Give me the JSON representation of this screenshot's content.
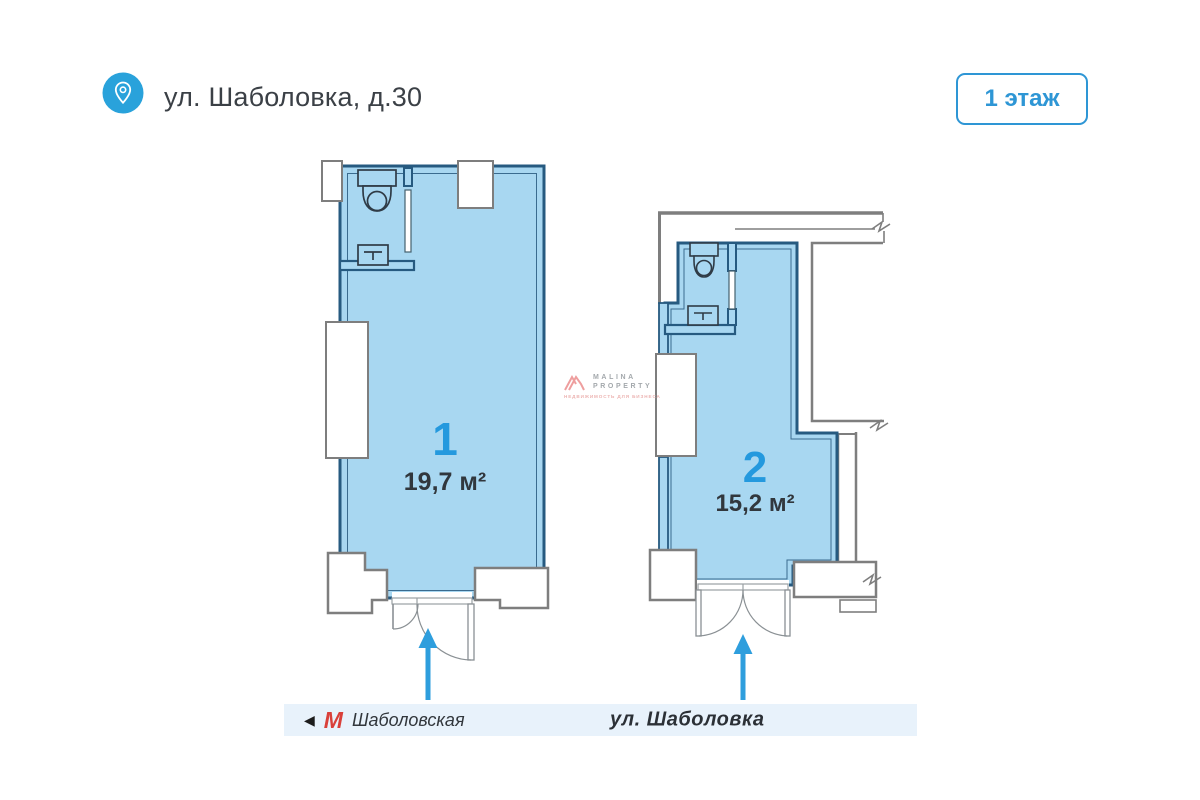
{
  "header": {
    "title": "ул. Шаболовка, д.30",
    "floor_badge": "1 этаж"
  },
  "units": [
    {
      "number": "1",
      "area": "19,7 м²"
    },
    {
      "number": "2",
      "area": "15,2 м²"
    }
  ],
  "street_bar": {
    "direction_arrow": "◀",
    "metro_symbol": "М",
    "metro_station": "Шаболовская",
    "street_name": "ул. Шаболовка"
  },
  "watermark": {
    "brand_line1": "MALINA",
    "brand_line2": "PROPERTY",
    "tagline": "НЕДВИЖИМОСТЬ ДЛЯ БИЗНЕСА"
  },
  "colors": {
    "accent_blue": "#2e96d5",
    "unit_number_blue": "#2499de",
    "plan_fill": "#a8d7f1",
    "plan_wall": "#265a80",
    "outline_gray": "#7e7e7e",
    "metro_red": "#d9403a",
    "street_bar_bg": "#e8f2fb",
    "arrow_blue": "#2e9edd"
  }
}
